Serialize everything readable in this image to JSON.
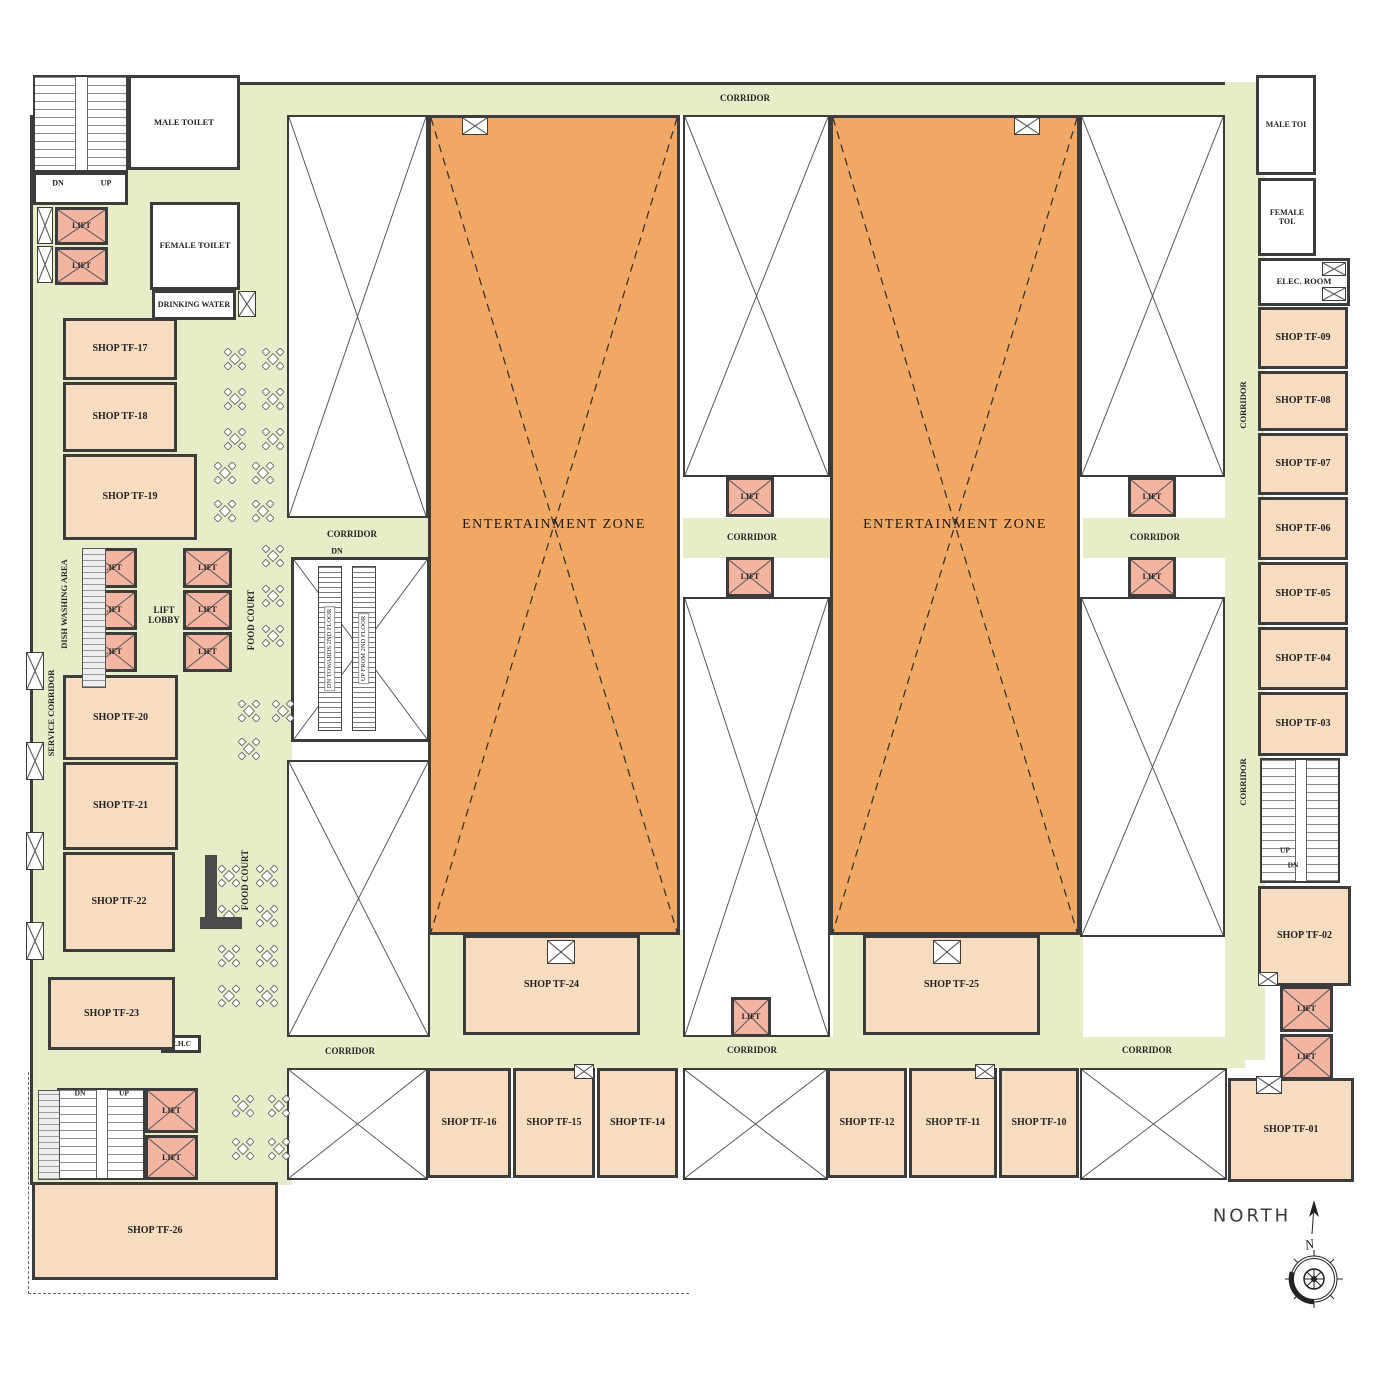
{
  "compass": {
    "label": "NORTH",
    "n": "N"
  },
  "colors": {
    "corridor": "#e8ecc9",
    "shop": "#f6ddc0",
    "entertainment_zone": "#f1a864",
    "lift": "#f4b4a2",
    "wall": "#3c3c3c"
  },
  "zones": [
    {
      "n": "corridor-top",
      "x": 232,
      "y": 82,
      "w": 1018,
      "h": 33,
      "b": "t"
    },
    {
      "n": "food-court-west-area",
      "x": 30,
      "y": 115,
      "w": 262,
      "h": 1070,
      "b": "l"
    },
    {
      "n": "corridor-escalator-band",
      "x": 287,
      "y": 518,
      "w": 143,
      "h": 40,
      "b": ""
    },
    {
      "n": "corridor-center-band",
      "x": 683,
      "y": 518,
      "w": 147,
      "h": 40,
      "b": ""
    },
    {
      "n": "corridor-east-band",
      "x": 1083,
      "y": 518,
      "w": 142,
      "h": 40,
      "b": ""
    },
    {
      "n": "corridor-east-vertical",
      "x": 1225,
      "y": 82,
      "w": 40,
      "h": 978,
      "b": ""
    },
    {
      "n": "corridor-bottom",
      "x": 195,
      "y": 1037,
      "w": 1050,
      "h": 31,
      "b": ""
    },
    {
      "n": "band-below-ez-west",
      "x": 430,
      "y": 930,
      "w": 253,
      "h": 107,
      "b": ""
    },
    {
      "n": "band-below-ez-east",
      "x": 833,
      "y": 930,
      "w": 250,
      "h": 107,
      "b": ""
    }
  ],
  "rooms": [
    {
      "n": "void-left-upper",
      "t": "void",
      "x": 287,
      "y": 115,
      "w": 141,
      "h": 403
    },
    {
      "n": "void-left-lower",
      "t": "void",
      "x": 287,
      "y": 760,
      "w": 143,
      "h": 277
    },
    {
      "n": "void-center-upper",
      "t": "void",
      "x": 683,
      "y": 115,
      "w": 147,
      "h": 362
    },
    {
      "n": "void-center-lower",
      "t": "void",
      "x": 683,
      "y": 597,
      "w": 147,
      "h": 440
    },
    {
      "n": "void-right-upper",
      "t": "void",
      "x": 1080,
      "y": 115,
      "w": 145,
      "h": 362
    },
    {
      "n": "void-right-lower",
      "t": "void",
      "x": 1080,
      "y": 597,
      "w": 145,
      "h": 340
    },
    {
      "n": "void-bottom-left",
      "t": "void",
      "x": 287,
      "y": 1068,
      "w": 141,
      "h": 112
    },
    {
      "n": "void-bottom-center",
      "t": "void",
      "x": 683,
      "y": 1068,
      "w": 145,
      "h": 112
    },
    {
      "n": "void-bottom-right",
      "t": "void",
      "x": 1080,
      "y": 1068,
      "w": 147,
      "h": 112
    },
    {
      "n": "entertainment-zone-west",
      "t": "ez",
      "l": "ENTERTAINMENT ZONE",
      "x": 428,
      "y": 115,
      "w": 252,
      "h": 820
    },
    {
      "n": "entertainment-zone-east",
      "t": "ez",
      "l": "ENTERTAINMENT ZONE",
      "x": 830,
      "y": 115,
      "w": 250,
      "h": 820
    },
    {
      "n": "staircase-northwest",
      "t": "stairs",
      "x": 33,
      "y": 75,
      "w": 95,
      "h": 97
    },
    {
      "n": "stairs-nw-vestibule",
      "t": "plain",
      "x": 33,
      "y": 172,
      "w": 95,
      "h": 33
    },
    {
      "n": "staircase-southwest",
      "t": "stairs",
      "x": 57,
      "y": 1088,
      "w": 88,
      "h": 92
    },
    {
      "n": "staircase-east",
      "t": "stairs",
      "x": 1260,
      "y": 758,
      "w": 80,
      "h": 125
    },
    {
      "n": "male-toilet",
      "t": "plain",
      "l": "MALE TOILET",
      "x": 128,
      "y": 75,
      "w": 112,
      "h": 95,
      "fs": 8.5
    },
    {
      "n": "female-toilet",
      "t": "plain",
      "l": "FEMALE TOILET",
      "x": 150,
      "y": 202,
      "w": 90,
      "h": 88,
      "fs": 8.5
    },
    {
      "n": "drinking-water",
      "t": "plain",
      "l": "DRINKING WATER",
      "x": 152,
      "y": 290,
      "w": 84,
      "h": 30,
      "fs": 8
    },
    {
      "n": "male-toilet-east",
      "t": "plain",
      "l": "MALE TOI",
      "x": 1256,
      "y": 75,
      "w": 60,
      "h": 100,
      "fs": 8
    },
    {
      "n": "female-toilet-east",
      "t": "plain",
      "l": "FEMALE TOI.",
      "x": 1258,
      "y": 178,
      "w": 58,
      "h": 78,
      "fs": 8
    },
    {
      "n": "electrical-room",
      "t": "plain",
      "l": "ELEC. ROOM",
      "x": 1258,
      "y": 258,
      "w": 92,
      "h": 48,
      "fs": 8.5
    },
    {
      "n": "ehc-room",
      "t": "plain",
      "l": "E.H.C",
      "x": 161,
      "y": 1035,
      "w": 40,
      "h": 18,
      "fs": 7.5
    },
    {
      "n": "shop-tf-17",
      "t": "shop",
      "l": "SHOP TF-17",
      "x": 63,
      "y": 318,
      "w": 114,
      "h": 62
    },
    {
      "n": "shop-tf-18",
      "t": "shop",
      "l": "SHOP TF-18",
      "x": 63,
      "y": 382,
      "w": 114,
      "h": 70
    },
    {
      "n": "shop-tf-19",
      "t": "shop",
      "l": "SHOP TF-19",
      "x": 63,
      "y": 454,
      "w": 134,
      "h": 86
    },
    {
      "n": "shop-tf-20",
      "t": "shop",
      "l": "SHOP TF-20",
      "x": 63,
      "y": 675,
      "w": 115,
      "h": 85
    },
    {
      "n": "shop-tf-21",
      "t": "shop",
      "l": "SHOP TF-21",
      "x": 63,
      "y": 762,
      "w": 115,
      "h": 88
    },
    {
      "n": "shop-tf-22",
      "t": "shop",
      "l": "SHOP TF-22",
      "x": 63,
      "y": 852,
      "w": 112,
      "h": 100
    },
    {
      "n": "shop-tf-23",
      "t": "shop",
      "l": "SHOP TF-23",
      "x": 48,
      "y": 977,
      "w": 127,
      "h": 73
    },
    {
      "n": "shop-tf-26",
      "t": "shop",
      "l": "SHOP TF-26",
      "x": 32,
      "y": 1182,
      "w": 246,
      "h": 98
    },
    {
      "n": "shop-tf-24",
      "t": "shop",
      "l": "SHOP TF-24",
      "x": 463,
      "y": 935,
      "w": 177,
      "h": 100
    },
    {
      "n": "shop-tf-25",
      "t": "shop",
      "l": "SHOP TF-25",
      "x": 863,
      "y": 935,
      "w": 177,
      "h": 100
    },
    {
      "n": "shop-tf-16",
      "t": "shop",
      "l": "SHOP TF-16",
      "x": 427,
      "y": 1068,
      "w": 84,
      "h": 110
    },
    {
      "n": "shop-tf-15",
      "t": "shop",
      "l": "SHOP TF-15",
      "x": 513,
      "y": 1068,
      "w": 82,
      "h": 110
    },
    {
      "n": "shop-tf-14",
      "t": "shop",
      "l": "SHOP TF-14",
      "x": 597,
      "y": 1068,
      "w": 81,
      "h": 110
    },
    {
      "n": "shop-tf-12",
      "t": "shop",
      "l": "SHOP TF-12",
      "x": 827,
      "y": 1068,
      "w": 80,
      "h": 110
    },
    {
      "n": "shop-tf-11",
      "t": "shop",
      "l": "SHOP TF-11",
      "x": 909,
      "y": 1068,
      "w": 88,
      "h": 110
    },
    {
      "n": "shop-tf-10",
      "t": "shop",
      "l": "SHOP TF-10",
      "x": 999,
      "y": 1068,
      "w": 80,
      "h": 110
    },
    {
      "n": "shop-tf-01",
      "t": "shop",
      "l": "SHOP TF-01",
      "x": 1228,
      "y": 1078,
      "w": 126,
      "h": 104
    },
    {
      "n": "shop-tf-02",
      "t": "shop",
      "l": "SHOP TF-02",
      "x": 1258,
      "y": 886,
      "w": 93,
      "h": 100
    },
    {
      "n": "shop-tf-09",
      "t": "shop",
      "l": "SHOP TF-09",
      "x": 1258,
      "y": 307,
      "w": 90,
      "h": 62
    },
    {
      "n": "shop-tf-08",
      "t": "shop",
      "l": "SHOP TF-08",
      "x": 1258,
      "y": 371,
      "w": 90,
      "h": 60
    },
    {
      "n": "shop-tf-07",
      "t": "shop",
      "l": "SHOP TF-07",
      "x": 1258,
      "y": 433,
      "w": 90,
      "h": 62
    },
    {
      "n": "shop-tf-06",
      "t": "shop",
      "l": "SHOP TF-06",
      "x": 1258,
      "y": 497,
      "w": 90,
      "h": 63
    },
    {
      "n": "shop-tf-05",
      "t": "shop",
      "l": "SHOP TF-05",
      "x": 1258,
      "y": 562,
      "w": 90,
      "h": 63
    },
    {
      "n": "shop-tf-04",
      "t": "shop",
      "l": "SHOP TF-04",
      "x": 1258,
      "y": 627,
      "w": 90,
      "h": 63
    },
    {
      "n": "shop-tf-03",
      "t": "shop",
      "l": "SHOP TF-03",
      "x": 1258,
      "y": 692,
      "w": 90,
      "h": 64
    },
    {
      "n": "lift-nw-1",
      "t": "lift",
      "l": "LIFT",
      "x": 55,
      "y": 207,
      "w": 53,
      "h": 38
    },
    {
      "n": "lift-nw-2",
      "t": "lift",
      "l": "LIFT",
      "x": 55,
      "y": 247,
      "w": 53,
      "h": 38
    },
    {
      "n": "lift-lobby-1",
      "t": "lift",
      "l": "LIFT",
      "x": 88,
      "y": 548,
      "w": 49,
      "h": 40
    },
    {
      "n": "lift-lobby-2",
      "t": "lift",
      "l": "LIFT",
      "x": 88,
      "y": 590,
      "w": 49,
      "h": 40
    },
    {
      "n": "lift-lobby-3",
      "t": "lift",
      "l": "LIFT",
      "x": 88,
      "y": 632,
      "w": 49,
      "h": 40
    },
    {
      "n": "lift-lobby-4",
      "t": "lift",
      "l": "LIFT",
      "x": 183,
      "y": 548,
      "w": 49,
      "h": 40
    },
    {
      "n": "lift-lobby-5",
      "t": "lift",
      "l": "LIFT",
      "x": 183,
      "y": 590,
      "w": 49,
      "h": 40
    },
    {
      "n": "lift-lobby-6",
      "t": "lift",
      "l": "LIFT",
      "x": 183,
      "y": 632,
      "w": 49,
      "h": 40
    },
    {
      "n": "lift-center-north",
      "t": "lift",
      "l": "LIFT",
      "x": 726,
      "y": 477,
      "w": 48,
      "h": 40
    },
    {
      "n": "lift-center-south",
      "t": "lift",
      "l": "LIFT",
      "x": 726,
      "y": 557,
      "w": 48,
      "h": 40
    },
    {
      "n": "lift-east-north",
      "t": "lift",
      "l": "LIFT",
      "x": 1128,
      "y": 477,
      "w": 48,
      "h": 40
    },
    {
      "n": "lift-east-south",
      "t": "lift",
      "l": "LIFT",
      "x": 1128,
      "y": 557,
      "w": 48,
      "h": 40
    },
    {
      "n": "lift-south-center",
      "t": "lift",
      "l": "LIFT",
      "x": 731,
      "y": 997,
      "w": 40,
      "h": 40
    },
    {
      "n": "lift-sw-1",
      "t": "lift",
      "l": "LIFT",
      "x": 145,
      "y": 1088,
      "w": 53,
      "h": 45
    },
    {
      "n": "lift-sw-2",
      "t": "lift",
      "l": "LIFT",
      "x": 145,
      "y": 1135,
      "w": 53,
      "h": 45
    },
    {
      "n": "lift-se-1",
      "t": "lift",
      "l": "LIFT",
      "x": 1280,
      "y": 986,
      "w": 53,
      "h": 46
    },
    {
      "n": "lift-se-2",
      "t": "lift",
      "l": "LIFT",
      "x": 1280,
      "y": 1034,
      "w": 53,
      "h": 46
    },
    {
      "n": "duct-nw-1",
      "t": "shaft",
      "x": 37,
      "y": 207,
      "w": 16,
      "h": 37
    },
    {
      "n": "duct-nw-2",
      "t": "shaft",
      "x": 37,
      "y": 246,
      "w": 16,
      "h": 37
    },
    {
      "n": "duct-service-1",
      "t": "shaft",
      "x": 26,
      "y": 652,
      "w": 18,
      "h": 38
    },
    {
      "n": "duct-service-2",
      "t": "shaft",
      "x": 26,
      "y": 742,
      "w": 18,
      "h": 38
    },
    {
      "n": "duct-service-3",
      "t": "shaft",
      "x": 26,
      "y": 832,
      "w": 18,
      "h": 38
    },
    {
      "n": "duct-service-4",
      "t": "shaft",
      "x": 26,
      "y": 922,
      "w": 18,
      "h": 38
    },
    {
      "n": "duct-elec-1",
      "t": "shaft",
      "x": 1322,
      "y": 262,
      "w": 24,
      "h": 14
    },
    {
      "n": "duct-elec-2",
      "t": "shaft",
      "x": 1322,
      "y": 287,
      "w": 24,
      "h": 14
    },
    {
      "n": "duct-tf24",
      "t": "shaft",
      "x": 547,
      "y": 940,
      "w": 28,
      "h": 24
    },
    {
      "n": "duct-tf25",
      "t": "shaft",
      "x": 933,
      "y": 940,
      "w": 28,
      "h": 24
    },
    {
      "n": "duct-ez-west",
      "t": "shaft",
      "x": 462,
      "y": 117,
      "w": 26,
      "h": 18
    },
    {
      "n": "duct-ez-east",
      "t": "shaft",
      "x": 1014,
      "y": 117,
      "w": 26,
      "h": 18
    },
    {
      "n": "duct-tf15",
      "t": "shaft",
      "x": 574,
      "y": 1064,
      "w": 20,
      "h": 15
    },
    {
      "n": "duct-tf11",
      "t": "shaft",
      "x": 975,
      "y": 1064,
      "w": 20,
      "h": 15
    },
    {
      "n": "duct-drinking-water",
      "t": "shaft",
      "x": 238,
      "y": 291,
      "w": 18,
      "h": 26
    },
    {
      "n": "duct-tf02",
      "t": "shaft",
      "x": 1258,
      "y": 972,
      "w": 20,
      "h": 14
    },
    {
      "n": "duct-tf01",
      "t": "shaft",
      "x": 1256,
      "y": 1076,
      "w": 26,
      "h": 18
    }
  ],
  "escalator": {
    "x": 291,
    "y": 557,
    "w": 139,
    "h": 185,
    "lanes": [
      {
        "n": "escalator-down",
        "label": "DN TOWARDS 2ND FLOOR"
      },
      {
        "n": "escalator-up",
        "label": "UP FROM 2ND FLOOR"
      }
    ]
  },
  "labels": [
    {
      "n": "corridor-label-top",
      "text": "CORRIDOR",
      "x": 745,
      "y": 98,
      "fs": 9
    },
    {
      "n": "corridor-label-escalator",
      "text": "CORRIDOR",
      "x": 352,
      "y": 534,
      "fs": 9
    },
    {
      "n": "escalator-dn-label",
      "text": "DN",
      "x": 337,
      "y": 551,
      "fs": 8
    },
    {
      "n": "corridor-label-center",
      "text": "CORRIDOR",
      "x": 752,
      "y": 537,
      "fs": 9
    },
    {
      "n": "corridor-label-east-mid",
      "text": "CORRIDOR",
      "x": 1155,
      "y": 537,
      "fs": 9
    },
    {
      "n": "corridor-label-bottom-west",
      "text": "CORRIDOR",
      "x": 350,
      "y": 1051,
      "fs": 9
    },
    {
      "n": "corridor-label-bottom-center",
      "text": "CORRIDOR",
      "x": 752,
      "y": 1050,
      "fs": 9
    },
    {
      "n": "corridor-label-bottom-east",
      "text": "CORRIDOR",
      "x": 1147,
      "y": 1050,
      "fs": 9
    },
    {
      "n": "corridor-label-east-vert-1",
      "text": "CORRIDOR",
      "x": 1243,
      "y": 405,
      "fs": 8.5,
      "rot": 1
    },
    {
      "n": "corridor-label-east-vert-2",
      "text": "CORRIDOR",
      "x": 1243,
      "y": 782,
      "fs": 8.5,
      "rot": 1
    },
    {
      "n": "food-court-label-1",
      "text": "FOOD COURT",
      "x": 251,
      "y": 620,
      "fs": 9,
      "rot": 1
    },
    {
      "n": "food-court-label-2",
      "text": "FOOD COURT",
      "x": 245,
      "y": 880,
      "fs": 9,
      "rot": 1
    },
    {
      "n": "dish-washing-area-label",
      "text": "DISH WASHING AREA",
      "x": 64,
      "y": 604,
      "fs": 8.5,
      "rot": 1
    },
    {
      "n": "service-corridor-label",
      "text": "SERVICE CORRIDOR",
      "x": 51,
      "y": 713,
      "fs": 8.5,
      "rot": 1
    },
    {
      "n": "lift-lobby-label",
      "text": "LIFT LOBBY",
      "x": 164,
      "y": 616,
      "fs": 9,
      "w": 46
    },
    {
      "n": "stairs-nw-dn",
      "text": "DN",
      "x": 58,
      "y": 183,
      "fs": 8
    },
    {
      "n": "stairs-nw-up",
      "text": "UP",
      "x": 106,
      "y": 183,
      "fs": 8
    },
    {
      "n": "stairs-sw-dn",
      "text": "DN",
      "x": 80,
      "y": 1093,
      "fs": 7.5
    },
    {
      "n": "stairs-sw-up",
      "text": "UP",
      "x": 124,
      "y": 1093,
      "fs": 7.5
    },
    {
      "n": "stairs-east-up",
      "text": "UP",
      "x": 1285,
      "y": 850,
      "fs": 7.5
    },
    {
      "n": "stairs-east-dn",
      "text": "DN",
      "x": 1293,
      "y": 865,
      "fs": 7.5
    }
  ],
  "tables": [
    [
      224,
      348
    ],
    [
      262,
      348
    ],
    [
      224,
      388
    ],
    [
      262,
      388
    ],
    [
      224,
      428
    ],
    [
      262,
      428
    ],
    [
      214,
      462
    ],
    [
      252,
      462
    ],
    [
      214,
      500
    ],
    [
      252,
      500
    ],
    [
      262,
      545
    ],
    [
      262,
      585
    ],
    [
      262,
      625
    ],
    [
      238,
      700
    ],
    [
      272,
      700
    ],
    [
      238,
      738
    ],
    [
      218,
      865
    ],
    [
      256,
      865
    ],
    [
      218,
      905
    ],
    [
      256,
      905
    ],
    [
      218,
      945
    ],
    [
      256,
      945
    ],
    [
      218,
      985
    ],
    [
      256,
      985
    ],
    [
      232,
      1095
    ],
    [
      268,
      1095
    ],
    [
      232,
      1138
    ],
    [
      268,
      1138
    ]
  ],
  "fixtures": [
    {
      "n": "dish-washing-counter",
      "x": 82,
      "y": 548,
      "w": 24,
      "h": 140,
      "c": "hatch"
    },
    {
      "n": "serving-counter-1",
      "x": 205,
      "y": 855,
      "w": 12,
      "h": 62,
      "c": "#4a4a4a"
    },
    {
      "n": "serving-counter-2",
      "x": 200,
      "y": 917,
      "w": 42,
      "h": 12,
      "c": "#4a4a4a"
    },
    {
      "n": "kitchen-strip-sw",
      "x": 38,
      "y": 1090,
      "w": 22,
      "h": 90,
      "c": "hatch"
    }
  ]
}
